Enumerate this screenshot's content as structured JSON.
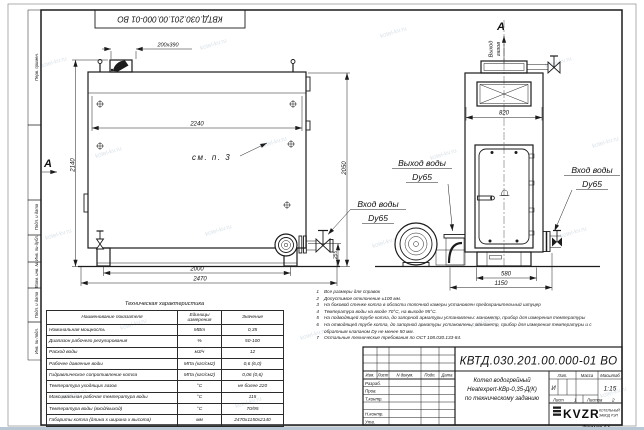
{
  "watermark": "kotel-kv.ru",
  "stamp_top": "КВТД.030.201.00.000-01 ВО",
  "margin_labels": [
    "Перв. примен.",
    "Подп. и дата",
    "Инв. № дубл.",
    "Взам. инв. №",
    "Подп. и дата",
    "Инв. № подл."
  ],
  "drawing": {
    "section_letter": "A",
    "see_ref": "см. п. 3",
    "gas_outlet": {
      "line1": "Выход",
      "line2": "газов"
    },
    "water_outlet": {
      "line1": "Выход воды",
      "line2": "Dy65"
    },
    "water_inlet": {
      "line1": "Вход воды",
      "line2": "Dy65"
    },
    "dims": {
      "side_top_width": "2240",
      "side_height_left": "2140",
      "side_height_right": "2050",
      "side_pump_height": "255",
      "side_leg_span": "2000",
      "side_total_length": "2470",
      "chimney": "200x390",
      "front_width": "820",
      "front_base": "580",
      "front_total": "1150"
    }
  },
  "notes": [
    {
      "n": "1",
      "text": "Все размеры для справок"
    },
    {
      "n": "2",
      "text": "Допустимое отклонение ±100 мм."
    },
    {
      "n": "3",
      "text": "На боковой стенке котла в области топочной камеры установлен предохранительный штуцер"
    },
    {
      "n": "4",
      "text": "Температура воды на входе 70°С, на выходе 95°С."
    },
    {
      "n": "5",
      "text": "На подводящей трубе котла, до запорной арматуры установлены: манометр, прибор для измерения температуры"
    },
    {
      "n": "6",
      "text": "На отводящей трубе котла, до запорной арматуры установлены: манометр, прибор для измерения температуры и с обратным клапаном Dу не менее 50 мм."
    },
    {
      "n": "7",
      "text": "Остальные технические требования по ОСТ 108.030.133-84."
    }
  ],
  "tech_table": {
    "title": "Техническая характеристика",
    "headers": [
      "Наименование показателя",
      "Единицы измерения",
      "Значение"
    ],
    "rows": [
      [
        "Номинальная мощность",
        "МВт",
        "0,35"
      ],
      [
        "Диапазон рабочего регулирования",
        "%",
        "50-100"
      ],
      [
        "Расход воды",
        "м3/ч",
        "12"
      ],
      [
        "Рабочее давление воды",
        "МПа (кгс/см2)",
        "0,6 (6,0)"
      ],
      [
        "Гидравлическое сопротивление котла",
        "МПа (кгс/см2)",
        "0,06 (0,6)"
      ],
      [
        "Температура уходящих газов",
        "°С",
        "не более 220"
      ],
      [
        "Максимальная рабочая температура воды",
        "°С",
        "115"
      ],
      [
        "Температура воды (вход/выход)",
        "°С",
        "70/95"
      ],
      [
        "Габариты котла (длина х ширина х высота)",
        "мм",
        "2470х1150х2140"
      ]
    ]
  },
  "title_block": {
    "doc_number": "КВТД.030.201.00.000-01 ВО",
    "product_name_lines": [
      "Котел водогрейный",
      "Heatexpert-КВр-0,35-Д(К)",
      "по техническому заданию"
    ],
    "header_cols": [
      "Изм.",
      "Лист",
      "N докум.",
      "Подп.",
      "Дата"
    ],
    "sig_rows": [
      "Разраб.",
      "Пров.",
      "Т.контр.",
      "",
      "Н.контр.",
      "Утв."
    ],
    "lit_label": "Лит.",
    "lit_value": "И",
    "mass_label": "Масса",
    "scale_label": "Масштаб",
    "scale_value": "1:15",
    "sheet_label": "Лист",
    "sheet_value": "1",
    "sheets_label": "Листов",
    "sheets_value": "2",
    "logo_text": "KVZR",
    "logo_caption": [
      "КОТЕЛЬНЫЙ",
      "ЗАВОД РЭП"
    ],
    "format_note": "Формат А3"
  }
}
